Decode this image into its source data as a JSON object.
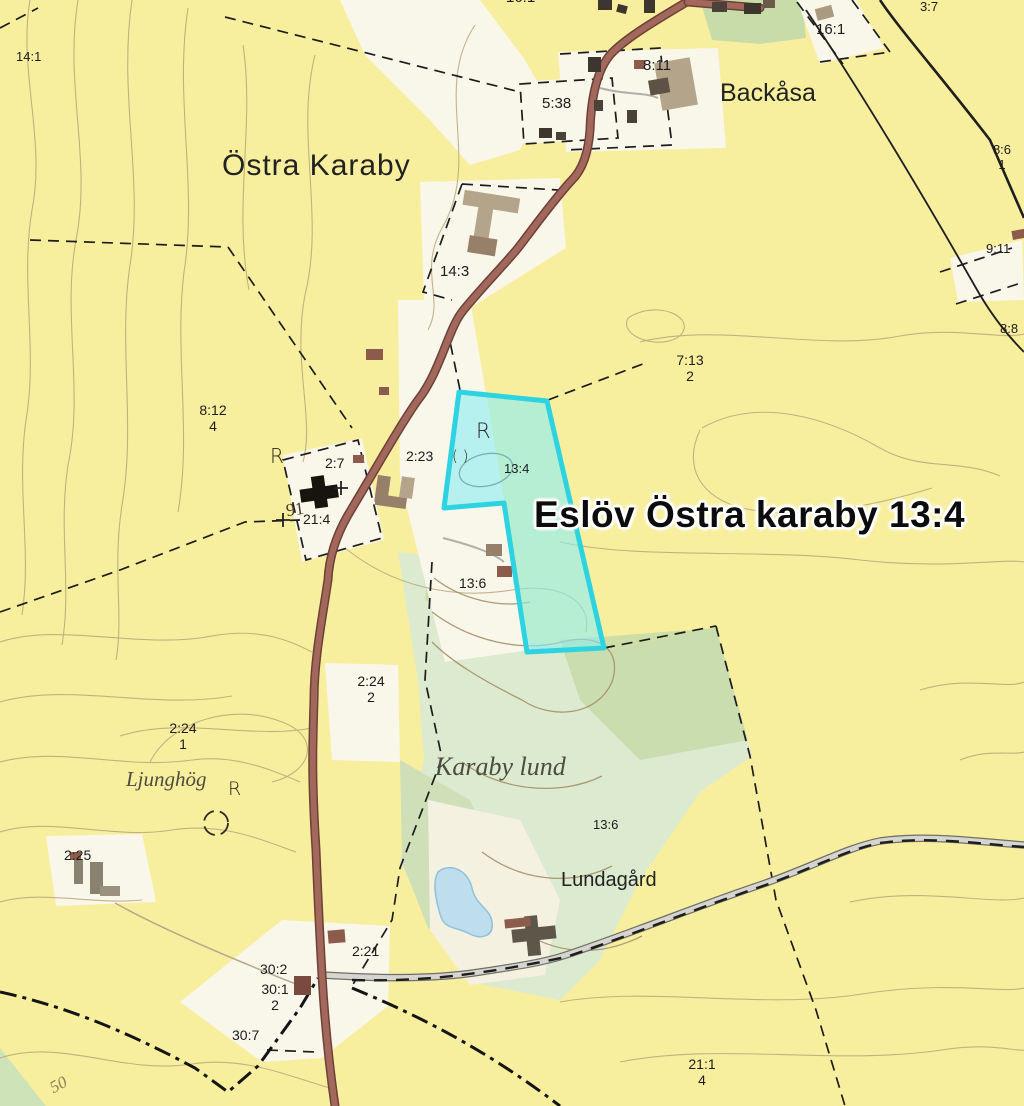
{
  "map_title_overlay": {
    "text": "Eslöv Östra karaby 13:4"
  },
  "place_names": {
    "ostra_karaby": "Östra Karaby",
    "backasa": "Backåsa",
    "ljunghog": "Ljunghög",
    "karaby_lund": "Karaby lund",
    "lundagard": "Lundagård"
  },
  "parcels": {
    "p14_1": "14:1",
    "p16_1_top": "16:1",
    "p3_7": "3:7",
    "p5_38": "5:38",
    "p8_11": "8:11",
    "p16_1": "16:1",
    "p8_6": {
      "top": "8:6",
      "bottom": "1"
    },
    "p9_11": "9:11",
    "p8_8": "8:8",
    "p14_3": "14:3",
    "p7_13": {
      "top": "7:13",
      "bottom": "2"
    },
    "p8_12": {
      "top": "8:12",
      "bottom": "4"
    },
    "p2_7": "2:7",
    "p2_23": "2:23",
    "p13_4": "13:4",
    "p21_4": "21:4",
    "p13_6_north": "13:6",
    "p2_24_2": {
      "top": "2:24",
      "bottom": "2"
    },
    "p2_24_1": {
      "top": "2:24",
      "bottom": "1"
    },
    "p2_25": "2:25",
    "p13_6_south": "13:6",
    "p2_21": "2:21",
    "p30_2": "30:2",
    "p30_1": {
      "top": "30:1",
      "bottom": "2"
    },
    "p30_7": "30:7",
    "p21_1": {
      "top": "21:1",
      "bottom": "4"
    }
  },
  "contour_labels": {
    "c91": "91",
    "c50": "50"
  },
  "symbols": {
    "ancient_monument": "R",
    "enclosure": "( )"
  },
  "colors": {
    "background": "#f8ef9e",
    "highlight_fill": "#8deef2",
    "highlight_border": "#2ed3e2",
    "woodland": "#dcead0",
    "main_road": "#a3685c",
    "water": "#bedeed"
  }
}
